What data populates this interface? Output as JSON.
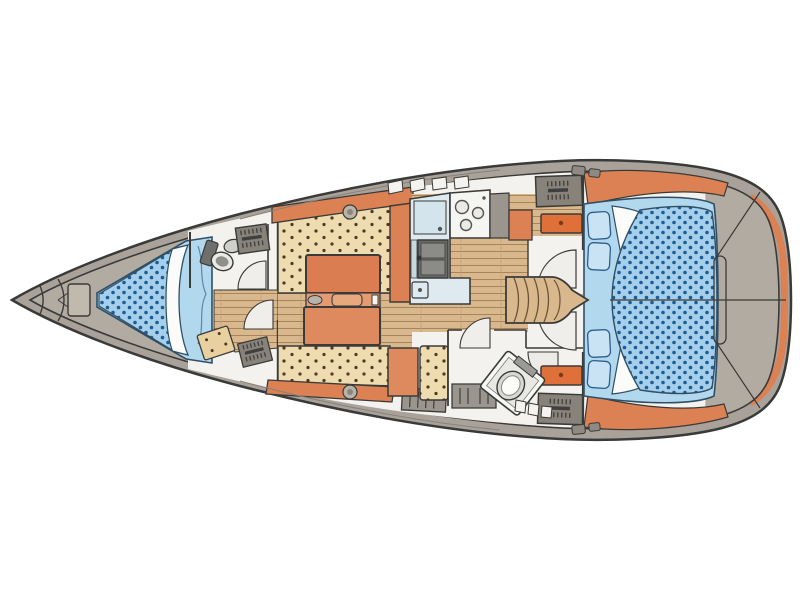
{
  "diagram": {
    "type": "sailboat-interior-floor-plan",
    "view": "top-down deck plan",
    "orientation": "bow-left-stern-right",
    "background": "#ffffff"
  },
  "colors": {
    "outline": "#3a3a38",
    "deck": "#a9a29b",
    "interior": "#b2aba1",
    "transom": "#b2aba1",
    "cabin_floor": "#f3f2ee",
    "wood": "#d9b88d",
    "wood_line": "#a9835a",
    "cushion": "#eedbb0",
    "cushion_dot": "#4a3a22",
    "accent_orange": "#dc8154",
    "table_top": "#da7e51",
    "table_mid": "#e59b72",
    "table_bottom": "#df8a5e",
    "drawer_orange": "#e0703a",
    "mattress_blue": "#a5cfeb",
    "mattress_dot": "#1d5d94",
    "bed_base_blue": "#b2d8ee",
    "pillow_blue": "#c9e3f4",
    "bed_outline": "#2f4f66",
    "sheet_white": "#fbfbf9",
    "counter_blue": "#dfeaf0",
    "appliance_white": "#f5f5f2",
    "sink_gray": "#6a6a68",
    "locker_gray": "#87827a",
    "cabinet_gray": "#9a958d",
    "hatch_gray": "#b9b3a9",
    "fan_white": "#efeeea",
    "chest_tan": "#e8d0a0"
  },
  "areas": {
    "bow_locker": "anchor-locker",
    "v_berth": "v-berth-double-bed",
    "forward_head": "forward-head-toilet-sink",
    "forward_wardrobe": "wardrobe-and-chest",
    "salon": "u-settee-with-folding-table",
    "galley": "galley-sink-stove-counter",
    "nav_station": "chart-table-and-seat",
    "companionway": "companionway-steps",
    "aft_head": "aft-head-toilet-shower",
    "aft_cabin": "aft-double-berth-with-pillows",
    "transom": "stern-platform"
  }
}
